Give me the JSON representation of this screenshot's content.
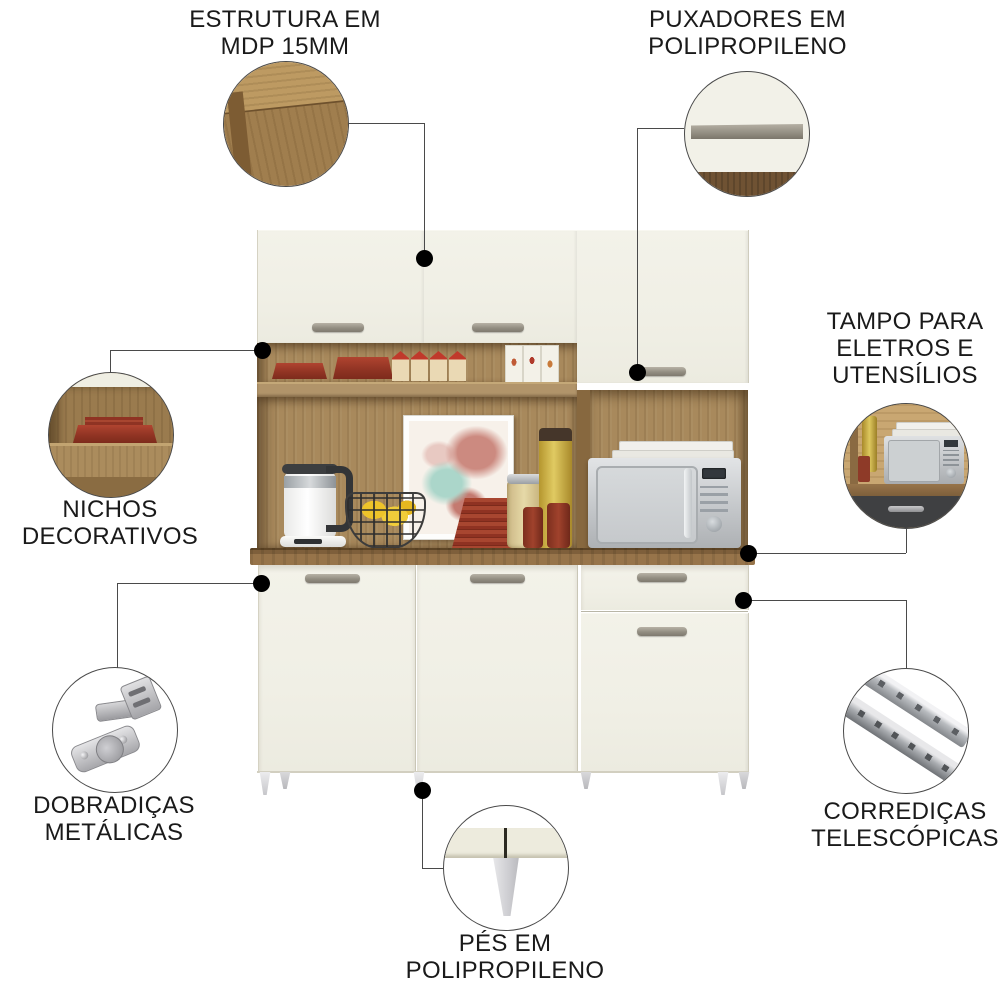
{
  "colors": {
    "background": "#ffffff",
    "door_front": "#f1f0e7",
    "wood": "#a8895c",
    "wood_dark": "#7e5f3b",
    "countertop": "#8a6741",
    "handle_metal": "#9a948a",
    "leader_line": "#4a4a4a",
    "dot": "#000000",
    "label_text": "#1a1a1a",
    "accent_red": "#9e3a26",
    "appliance_metal": "#c6c9cc"
  },
  "callouts": {
    "estrutura": {
      "lines": [
        "ESTRUTURA EM",
        "MDP 15MM"
      ],
      "detail_icon": "wood-corner-photo"
    },
    "puxadores": {
      "lines": [
        "PUXADORES EM",
        "POLIPROPILENO"
      ],
      "detail_icon": "door-handle-photo"
    },
    "tampo": {
      "lines": [
        "TAMPO PARA",
        "ELETROS E",
        "UTENSÍLIOS"
      ],
      "detail_icon": "microwave-countertop-photo"
    },
    "nichos": {
      "lines": [
        "NICHOS",
        "DECORATIVOS"
      ],
      "detail_icon": "decorative-niche-photo"
    },
    "dobradicas": {
      "lines": [
        "DOBRADIÇAS",
        "METÁLICAS"
      ],
      "detail_icon": "metal-hinge-photo"
    },
    "corredicas": {
      "lines": [
        "CORREDIÇAS",
        "TELESCÓPICAS"
      ],
      "detail_icon": "telescopic-slide-photo"
    },
    "pes": {
      "lines": [
        "PÉS EM",
        "POLIPROPILENO"
      ],
      "detail_icon": "plastic-foot-photo"
    }
  }
}
